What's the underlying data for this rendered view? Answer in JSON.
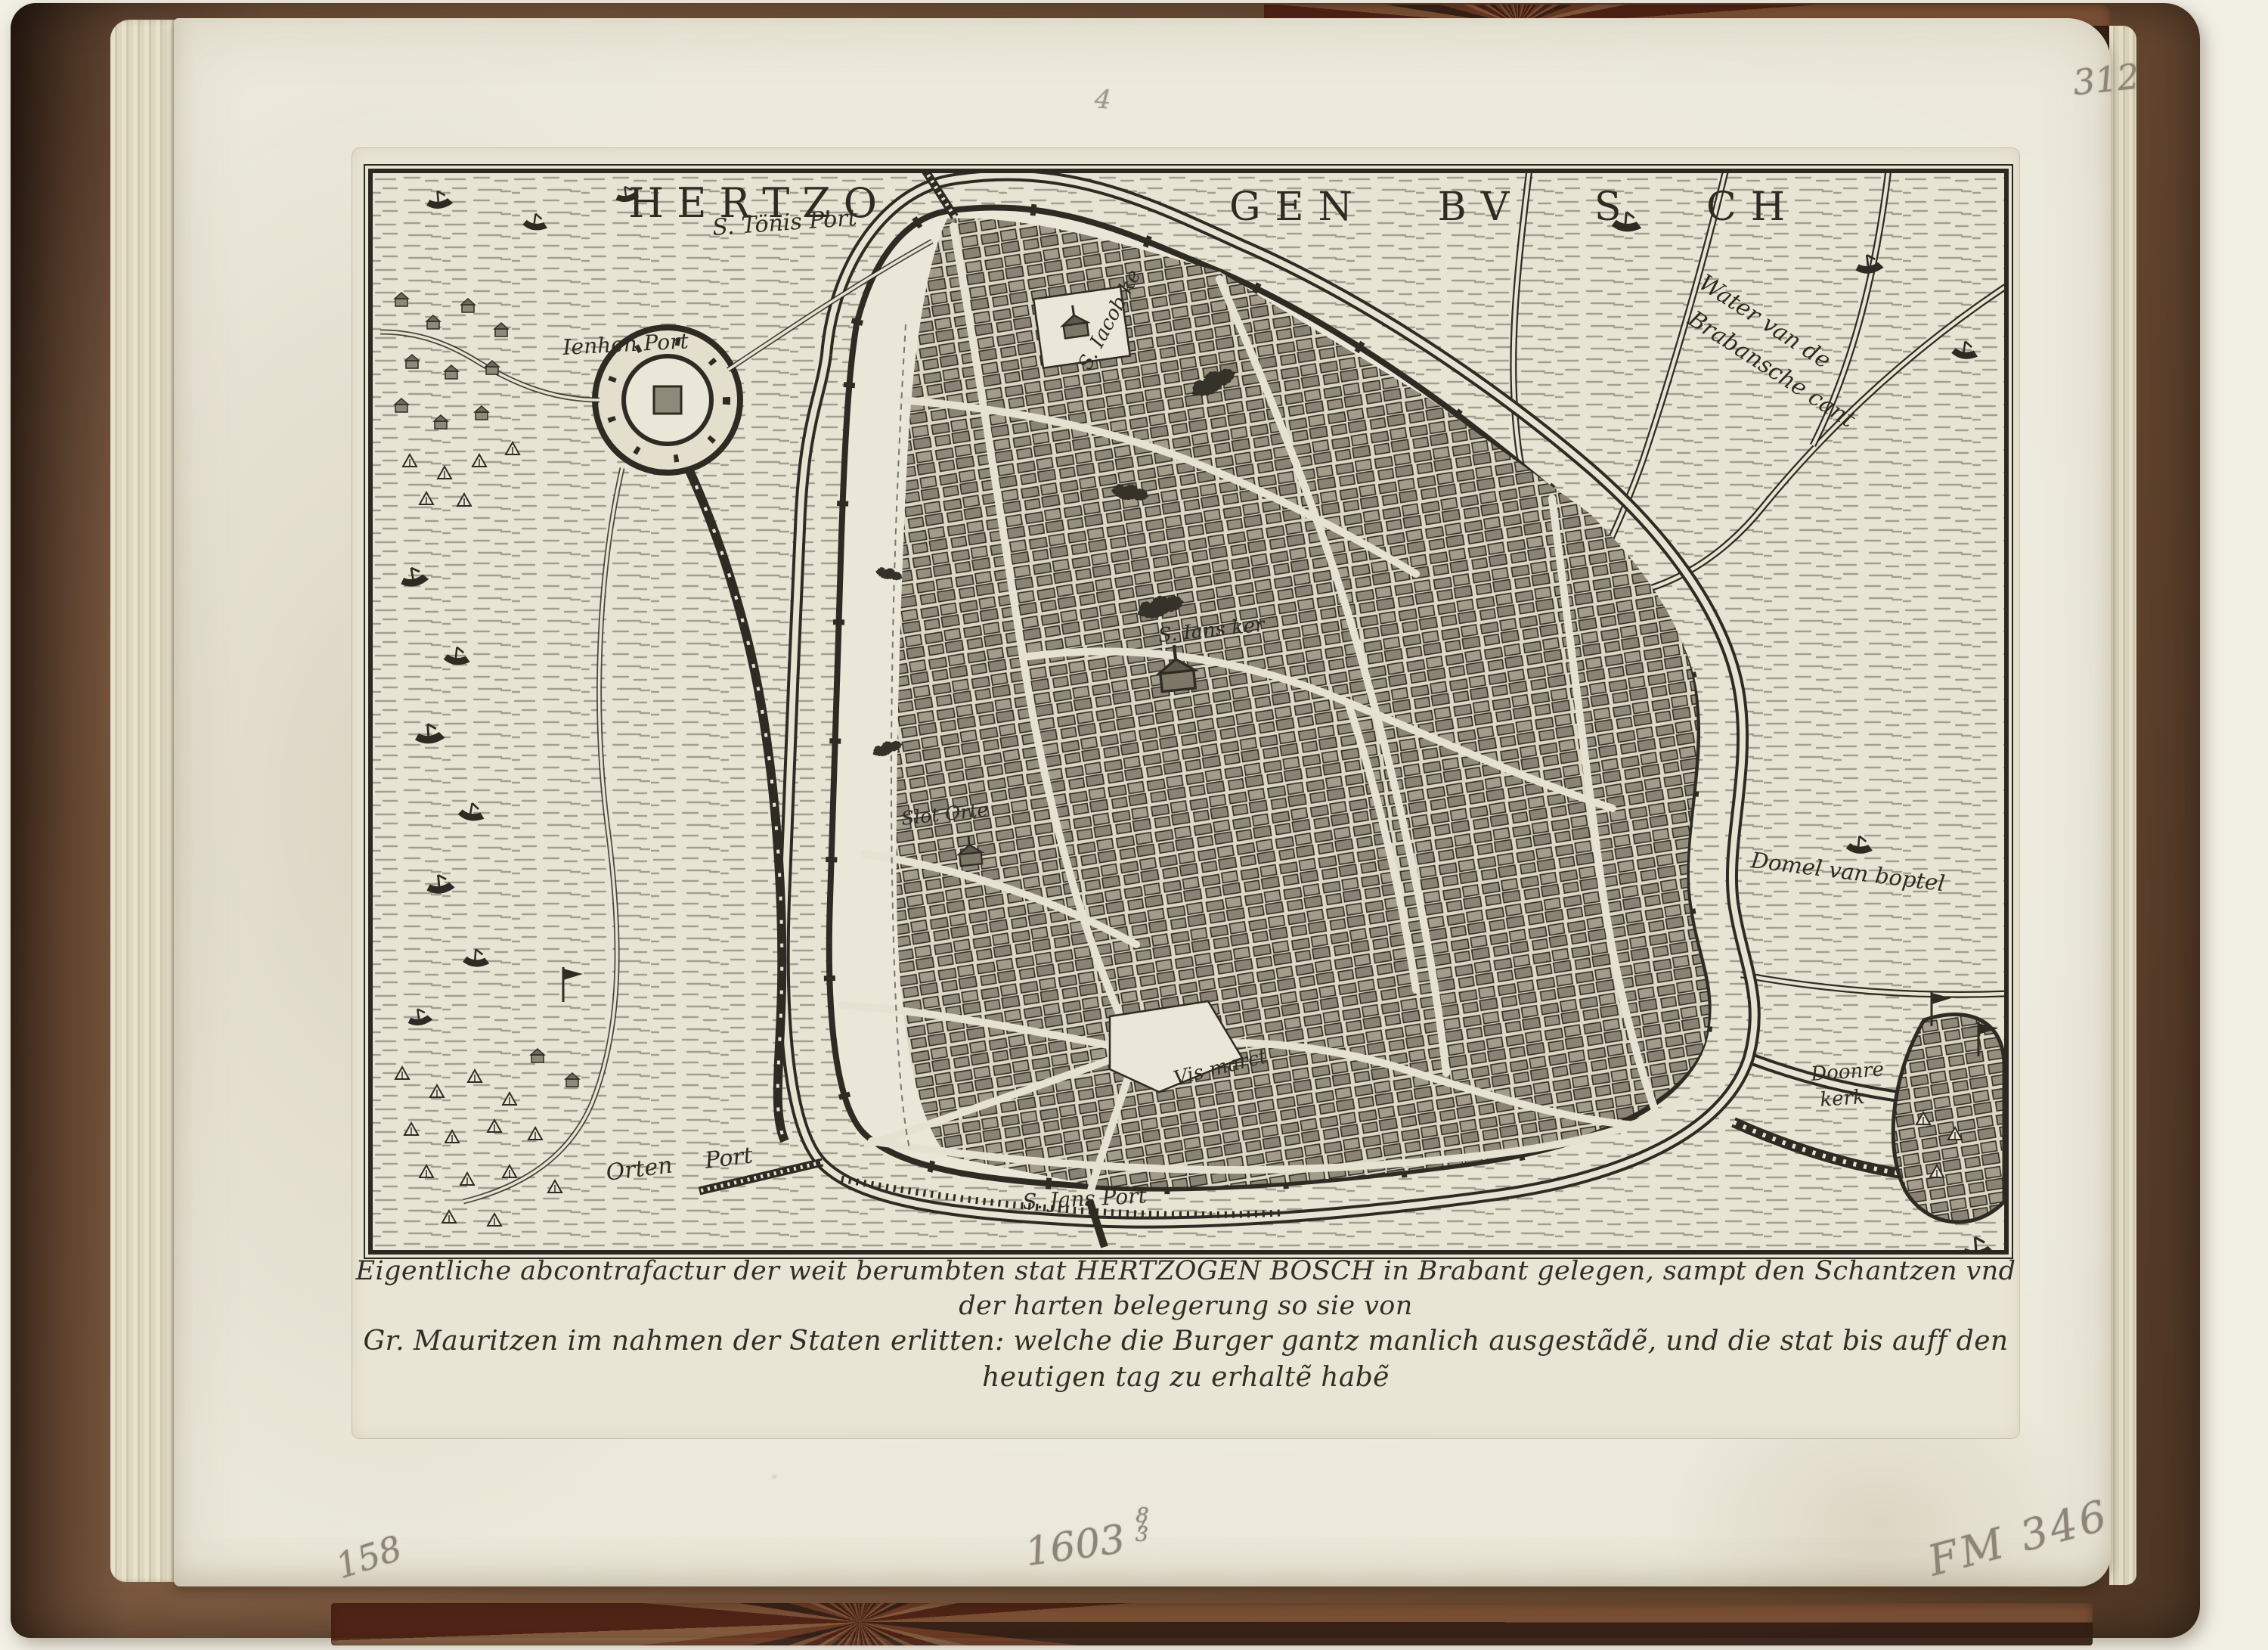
{
  "annotations": {
    "top_right_number": "312",
    "top_center_number": "4",
    "bottom_left_number": "158",
    "bottom_center_year": "1603",
    "bottom_center_fraction_top": "8",
    "bottom_center_fraction_bottom": "3",
    "bottom_right_inventory": "FM 346"
  },
  "map": {
    "title_part1": "HERTZO",
    "title_part2": "GEN BV S CH",
    "labels": {
      "s_tonis_port": "S. Tönis Port",
      "ienhen_port": "Ienhen Port",
      "s_iacob_kerk": "S. Iacob ke",
      "water_brabant_line1": "Water van de",
      "water_brabant_line2": "Brabansche cant",
      "s_ians_kerk": "S. Ians ker",
      "slot_orte": "Slot Orte",
      "domel": "Domel van boptel",
      "vis_marct": "Vis marct",
      "doonre_line1": "Doonre",
      "doonre_line2": "kerk",
      "orten_port": "Orten Port",
      "s_ians_port": "S. Jans Port"
    },
    "caption_line1": "Eigentliche abcontrafactur der weit berumbten stat HERTZOGEN BOSCH in Brabant gelegen, sampt den Schantzen vnd der harten belegerung so sie von",
    "caption_line2": "Gr. Mauritzen im nahmen der Staten erlitten: welche die Burger gantz manlich ausgestãdẽ, und die stat bis auff den heutigen tag zu erhaltẽ habẽ"
  }
}
